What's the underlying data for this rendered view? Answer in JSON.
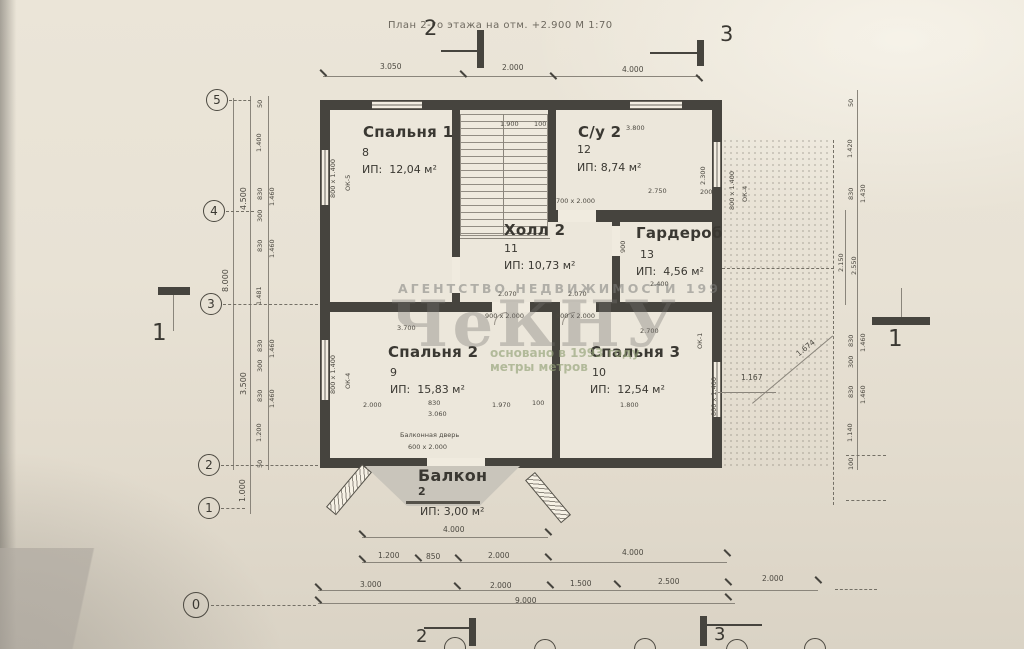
{
  "title": "План 2-го этажа на отм. +2.900 М 1:70",
  "watermark": {
    "agency": "АГЕНТСТВО  НЕДВИЖИМОСТИ  199",
    "logo": "ЧеКНУ",
    "tagline_line1": "основано в 1993 году",
    "tagline_line2": "метры метров"
  },
  "rooms": {
    "bedroom1": {
      "name": "Спальня 1",
      "num": "8",
      "area": "ИП:  12,04 м²"
    },
    "bath": {
      "name": "С/у 2",
      "num": "12",
      "area": "ИП: 8,74 м²"
    },
    "hall": {
      "name": "Холл 2",
      "num": "11",
      "area": "ИП: 10,73 м²"
    },
    "wardrobe": {
      "name": "Гардероб",
      "num": "13",
      "area": "ИП:  4,56 м²"
    },
    "bedroom2": {
      "name": "Спальня 2",
      "num": "9",
      "area": "ИП:  15,83 м²"
    },
    "bedroom3": {
      "name": "Спальня 3",
      "num": "10",
      "area": "ИП:  12,54 м²"
    },
    "balcony": {
      "name": "Балкон",
      "num": "2",
      "area": "ИП: 3,00 м²"
    }
  },
  "balcony_door": {
    "line1": "Балконная дверь",
    "line2": "600 х 2.000"
  },
  "axes": {
    "top_left": "2",
    "top_right": "3",
    "left": [
      "5",
      "4",
      "3",
      "2",
      "1"
    ],
    "zero": "0",
    "section_left": "1",
    "section_right": "1",
    "bottom_left": "2",
    "bottom_right": "3"
  },
  "dims": {
    "top": [
      "3.050",
      "2.000",
      "4.000"
    ],
    "bottom_r1": "4.000",
    "bottom_r2": [
      "1.200",
      "850",
      "2.000",
      "4.000"
    ],
    "bottom_r3": [
      "3.000",
      "2.000",
      "1.500",
      "2.500",
      "2.000"
    ],
    "bottom_r4": "9.000",
    "left_outer": "8.000",
    "left_mid": [
      "4.500",
      "3.500",
      "1.000"
    ],
    "left_inner": [
      "50",
      "1.400",
      "830",
      "1.460",
      "300",
      "830",
      "1.460",
      "1.481",
      "830",
      "1.460",
      "300",
      "830",
      "1.460",
      "1.200",
      "50"
    ],
    "right_inner": [
      "50",
      "1.420",
      "830",
      "1.430",
      "2.150",
      "2.550",
      "830",
      "1.460",
      "300",
      "830",
      "1.460",
      "1.140",
      "100"
    ]
  },
  "labels": {
    "stairs_w": "1.900",
    "stairs_g": "100",
    "bath_top": "3.800",
    "bath_bottom": "2.750",
    "bath_200": "200",
    "bath_right": "2.300",
    "bath_door": "700 х 2.000",
    "ward_bottom": "2.400",
    "ward_left": "900",
    "door_h1": "2.070",
    "door_h2": "2.070",
    "door_left": "900 х 2.000",
    "door_right": "800 х 2.000",
    "wall_dim": "3.700",
    "bed2_d1": "2.000",
    "bed2_d2": "830",
    "bed2_d3": "1.970",
    "bed2_d4": "100",
    "bed2_d5": "3.060",
    "bed3_top": "2.700",
    "bed3_bottom": "1.800",
    "offset": "1.167",
    "diag": "1.674",
    "win1": "800 х 1.400",
    "win1_ok": "ОК-5",
    "win2": "800 х 1.400",
    "win2_ok": "ОК-4",
    "win3": "800 х 1.400",
    "win3_ok": "ОК-1",
    "roof_win": "800 х 1.400",
    "roof_ok": "ОК-4"
  }
}
